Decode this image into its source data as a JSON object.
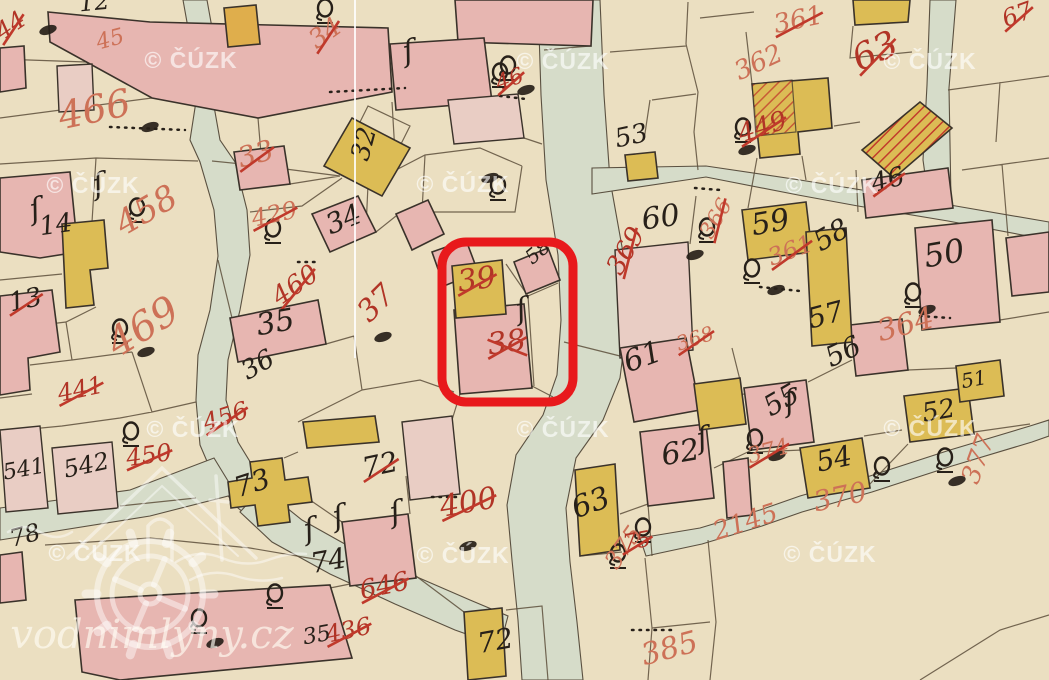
{
  "map": {
    "description_label": "historic cadastral map sheet",
    "colors": {
      "background": "#ebdfc1",
      "road": "#d6dcc9",
      "building_pink": "#e7b6b1",
      "building_pink_pale": "#e9cdc4",
      "building_yellow": "#dcbc55",
      "hatch_red": "#c23b2c",
      "parcel_line": "#5d4f3b",
      "building_stroke": "#3a322a",
      "ink_red": "#b13426",
      "ink_red_light": "#cd7157",
      "ink_black": "#272019",
      "strike_red": "#c0392b",
      "watermark_text": "rgba(255,255,255,0.62)",
      "brand_text": "rgba(255,252,243,0.66)",
      "highlight_red": "#e8191c",
      "scan_line": "rgba(255,255,255,0.85)"
    },
    "watermark": {
      "text": "© ČÚZK",
      "font_size": 23,
      "positions": [
        {
          "x": 191,
          "y": 68
        },
        {
          "x": 563,
          "y": 69
        },
        {
          "x": 930,
          "y": 69
        },
        {
          "x": 93,
          "y": 193
        },
        {
          "x": 463,
          "y": 192
        },
        {
          "x": 832,
          "y": 193
        },
        {
          "x": 193,
          "y": 437
        },
        {
          "x": 563,
          "y": 437
        },
        {
          "x": 930,
          "y": 436
        },
        {
          "x": 95,
          "y": 561
        },
        {
          "x": 463,
          "y": 563
        },
        {
          "x": 830,
          "y": 562
        }
      ]
    },
    "brand": {
      "text": "vodnimlyny.cz",
      "font_size": 40,
      "x": 152,
      "y": 648
    },
    "highlight": {
      "shape": "rounded-rect",
      "x": 442,
      "y": 242,
      "width": 131,
      "height": 160,
      "radius": 24,
      "stroke_width": 9,
      "highlighted_parcels": [
        "39",
        "38"
      ]
    },
    "parcel_labels": [
      {
        "t": "466",
        "x": 97,
        "y": 122,
        "ink": "rl",
        "s": 38,
        "r": -12,
        "k": 0
      },
      {
        "t": "33",
        "x": 258,
        "y": 163,
        "ink": "rl",
        "s": 28,
        "r": -15,
        "k": 1
      },
      {
        "t": "458",
        "x": 152,
        "y": 220,
        "ink": "rl",
        "s": 34,
        "r": -30,
        "k": 0
      },
      {
        "t": "469",
        "x": 150,
        "y": 338,
        "ink": "rl",
        "s": 40,
        "r": -32,
        "k": 0
      },
      {
        "t": "13",
        "x": 27,
        "y": 308,
        "ink": "b",
        "s": 26,
        "r": -12,
        "k": 1
      },
      {
        "t": "14",
        "x": 57,
        "y": 233,
        "ink": "b",
        "s": 26,
        "r": -8,
        "k": 0
      },
      {
        "t": "34",
        "x": 347,
        "y": 228,
        "ink": "b",
        "s": 28,
        "r": -22,
        "k": 0
      },
      {
        "t": "429",
        "x": 276,
        "y": 222,
        "ink": "rl",
        "s": 24,
        "r": -12,
        "k": 1
      },
      {
        "t": "460",
        "x": 300,
        "y": 292,
        "ink": "r",
        "s": 26,
        "r": -35,
        "k": 1
      },
      {
        "t": "35",
        "x": 277,
        "y": 332,
        "ink": "b",
        "s": 30,
        "r": -10,
        "k": 0
      },
      {
        "t": "36",
        "x": 262,
        "y": 372,
        "ink": "b",
        "s": 26,
        "r": -30,
        "k": 0
      },
      {
        "t": "37",
        "x": 383,
        "y": 310,
        "ink": "r",
        "s": 30,
        "r": -45,
        "k": 0
      },
      {
        "t": "39",
        "x": 478,
        "y": 289,
        "ink": "r",
        "s": 30,
        "r": -8,
        "k": 1
      },
      {
        "t": "38",
        "x": 508,
        "y": 352,
        "ink": "r",
        "s": 30,
        "r": -8,
        "k": 2
      },
      {
        "t": "58",
        "x": 542,
        "y": 257,
        "ink": "b",
        "s": 20,
        "r": -40,
        "k": 0
      },
      {
        "t": "32",
        "x": 372,
        "y": 146,
        "ink": "b",
        "s": 26,
        "r": -75,
        "k": 0
      },
      {
        "t": "53",
        "x": 633,
        "y": 144,
        "ink": "b",
        "s": 26,
        "r": -12,
        "k": 0
      },
      {
        "t": "60",
        "x": 662,
        "y": 227,
        "ink": "b",
        "s": 30,
        "r": -8,
        "k": 0
      },
      {
        "t": "369",
        "x": 633,
        "y": 255,
        "ink": "r",
        "s": 26,
        "r": -60,
        "k": 1
      },
      {
        "t": "59",
        "x": 772,
        "y": 232,
        "ink": "b",
        "s": 30,
        "r": -10,
        "k": 0
      },
      {
        "t": "58",
        "x": 836,
        "y": 243,
        "ink": "b",
        "s": 28,
        "r": -30,
        "k": 0
      },
      {
        "t": "361",
        "x": 793,
        "y": 258,
        "ink": "rl",
        "s": 24,
        "r": -20,
        "k": 1
      },
      {
        "t": "366",
        "x": 722,
        "y": 222,
        "ink": "rl",
        "s": 22,
        "r": -60,
        "k": 1
      },
      {
        "t": "57",
        "x": 828,
        "y": 324,
        "ink": "b",
        "s": 28,
        "r": -15,
        "k": 0
      },
      {
        "t": "56",
        "x": 847,
        "y": 360,
        "ink": "b",
        "s": 28,
        "r": -25,
        "k": 0
      },
      {
        "t": "50",
        "x": 946,
        "y": 264,
        "ink": "b",
        "s": 32,
        "r": -10,
        "k": 0
      },
      {
        "t": "364",
        "x": 908,
        "y": 334,
        "ink": "rl",
        "s": 30,
        "r": -15,
        "k": 0
      },
      {
        "t": "46",
        "x": 890,
        "y": 188,
        "ink": "b",
        "s": 26,
        "r": -15,
        "k": 1
      },
      {
        "t": "63",
        "x": 880,
        "y": 62,
        "ink": "r",
        "s": 36,
        "r": -25,
        "k": 1
      },
      {
        "t": "361",
        "x": 800,
        "y": 28,
        "ink": "rl",
        "s": 26,
        "r": -12,
        "k": 1
      },
      {
        "t": "362",
        "x": 762,
        "y": 70,
        "ink": "rl",
        "s": 26,
        "r": -25,
        "k": 0
      },
      {
        "t": "63",
        "x": 594,
        "y": 512,
        "ink": "b",
        "s": 30,
        "r": -20,
        "k": 0
      },
      {
        "t": "61",
        "x": 646,
        "y": 366,
        "ink": "b",
        "s": 30,
        "r": -20,
        "k": 0
      },
      {
        "t": "62",
        "x": 682,
        "y": 462,
        "ink": "b",
        "s": 30,
        "r": -10,
        "k": 0
      },
      {
        "t": "55",
        "x": 786,
        "y": 408,
        "ink": "b",
        "s": 28,
        "r": -30,
        "k": 0
      },
      {
        "t": "374",
        "x": 770,
        "y": 458,
        "ink": "rl",
        "s": 22,
        "r": -15,
        "k": 1
      },
      {
        "t": "54",
        "x": 836,
        "y": 468,
        "ink": "b",
        "s": 28,
        "r": -12,
        "k": 0
      },
      {
        "t": "370",
        "x": 842,
        "y": 506,
        "ink": "rl",
        "s": 28,
        "r": -12,
        "k": 0
      },
      {
        "t": "52",
        "x": 940,
        "y": 419,
        "ink": "b",
        "s": 26,
        "r": -10,
        "k": 0
      },
      {
        "t": "377",
        "x": 986,
        "y": 462,
        "ink": "rl",
        "s": 26,
        "r": -70,
        "k": 0
      },
      {
        "t": "51",
        "x": 975,
        "y": 386,
        "ink": "b",
        "s": 20,
        "r": -10,
        "k": 0
      },
      {
        "t": "73",
        "x": 255,
        "y": 492,
        "ink": "b",
        "s": 28,
        "r": -18,
        "k": 0
      },
      {
        "t": "72",
        "x": 382,
        "y": 474,
        "ink": "b",
        "s": 28,
        "r": -12,
        "k": 1
      },
      {
        "t": "400",
        "x": 470,
        "y": 512,
        "ink": "r",
        "s": 30,
        "r": -10,
        "k": 1
      },
      {
        "t": "74",
        "x": 330,
        "y": 570,
        "ink": "b",
        "s": 28,
        "r": -10,
        "k": 0
      },
      {
        "t": "646",
        "x": 386,
        "y": 594,
        "ink": "r",
        "s": 26,
        "r": -12,
        "k": 1
      },
      {
        "t": "436",
        "x": 350,
        "y": 638,
        "ink": "r",
        "s": 24,
        "r": -12,
        "k": 1
      },
      {
        "t": "35",
        "x": 318,
        "y": 642,
        "ink": "b",
        "s": 22,
        "r": -10,
        "k": 0
      },
      {
        "t": "72",
        "x": 497,
        "y": 650,
        "ink": "b",
        "s": 28,
        "r": -10,
        "k": 0
      },
      {
        "t": "375",
        "x": 630,
        "y": 552,
        "ink": "rl",
        "s": 24,
        "r": -55,
        "k": 0
      },
      {
        "t": "385",
        "x": 672,
        "y": 658,
        "ink": "rl",
        "s": 30,
        "r": -15,
        "k": 0
      },
      {
        "t": "541",
        "x": 25,
        "y": 476,
        "ink": "b",
        "s": 22,
        "r": -10,
        "k": 0
      },
      {
        "t": "542",
        "x": 88,
        "y": 473,
        "ink": "b",
        "s": 24,
        "r": -12,
        "k": 0
      },
      {
        "t": "441",
        "x": 82,
        "y": 397,
        "ink": "r",
        "s": 24,
        "r": -12,
        "k": 1
      },
      {
        "t": "450",
        "x": 150,
        "y": 463,
        "ink": "r",
        "s": 24,
        "r": -8,
        "k": 1
      },
      {
        "t": "456",
        "x": 228,
        "y": 424,
        "ink": "r",
        "s": 24,
        "r": -18,
        "k": 1
      },
      {
        "t": "78",
        "x": 27,
        "y": 543,
        "ink": "b",
        "s": 24,
        "r": -15,
        "k": 0
      },
      {
        "t": "449",
        "x": 765,
        "y": 135,
        "ink": "r",
        "s": 26,
        "r": -18,
        "k": 1
      },
      {
        "t": "46",
        "x": 512,
        "y": 86,
        "ink": "r",
        "s": 22,
        "r": -20,
        "k": 1
      },
      {
        "t": "34",
        "x": 330,
        "y": 40,
        "ink": "rl",
        "s": 26,
        "r": -35,
        "k": 1
      },
      {
        "t": "368",
        "x": 697,
        "y": 345,
        "ink": "rl",
        "s": 20,
        "r": -18,
        "k": 1
      },
      {
        "t": "44",
        "x": 15,
        "y": 32,
        "ink": "r",
        "s": 24,
        "r": -35,
        "k": 1
      },
      {
        "t": "45",
        "x": 112,
        "y": 46,
        "ink": "rl",
        "s": 22,
        "r": -15,
        "k": 0
      },
      {
        "t": "12",
        "x": 95,
        "y": 10,
        "ink": "b",
        "s": 24,
        "r": -5,
        "k": 0
      },
      {
        "t": "2145",
        "x": 748,
        "y": 530,
        "ink": "rl",
        "s": 26,
        "r": -18,
        "k": 0
      },
      {
        "t": "75",
        "x": 638,
        "y": 548,
        "ink": "r",
        "s": 22,
        "r": -10,
        "k": 1
      },
      {
        "t": "67",
        "x": 1020,
        "y": 22,
        "ink": "r",
        "s": 24,
        "r": -20,
        "k": 1
      }
    ],
    "symbols": {
      "circle_marks": [
        [
          508,
          65
        ],
        [
          137,
          207
        ],
        [
          120,
          328
        ],
        [
          273,
          228
        ],
        [
          707,
          227
        ],
        [
          752,
          268
        ],
        [
          913,
          292
        ],
        [
          199,
          618
        ],
        [
          275,
          593
        ],
        [
          618,
          553
        ],
        [
          755,
          438
        ],
        [
          643,
          527
        ],
        [
          882,
          466
        ],
        [
          945,
          457
        ],
        [
          131,
          431
        ],
        [
          500,
          72
        ],
        [
          498,
          185
        ],
        [
          743,
          127
        ],
        [
          325,
          8
        ]
      ],
      "ink_blobs": [
        [
          150,
          127
        ],
        [
          526,
          90
        ],
        [
          776,
          290
        ],
        [
          927,
          310
        ],
        [
          468,
          546
        ],
        [
          215,
          643
        ],
        [
          777,
          456
        ],
        [
          957,
          481
        ],
        [
          146,
          352
        ],
        [
          383,
          337
        ],
        [
          490,
          178
        ],
        [
          747,
          150
        ],
        [
          48,
          30
        ],
        [
          695,
          255
        ]
      ],
      "flourishes": [
        [
          32,
          220
        ],
        [
          335,
          527
        ],
        [
          392,
          523
        ],
        [
          306,
          540
        ],
        [
          699,
          449
        ],
        [
          518,
          320
        ],
        [
          786,
          412
        ],
        [
          95,
          195
        ],
        [
          405,
          62
        ]
      ],
      "dot_rows": [
        [
          330,
          92,
          405,
          88
        ],
        [
          500,
          96,
          526,
          99
        ],
        [
          298,
          262,
          318,
          262
        ],
        [
          760,
          287,
          800,
          291
        ],
        [
          920,
          316,
          950,
          318
        ],
        [
          632,
          630,
          672,
          630
        ],
        [
          110,
          127,
          185,
          130
        ],
        [
          432,
          497,
          458,
          497
        ],
        [
          695,
          188,
          720,
          190
        ]
      ]
    }
  }
}
